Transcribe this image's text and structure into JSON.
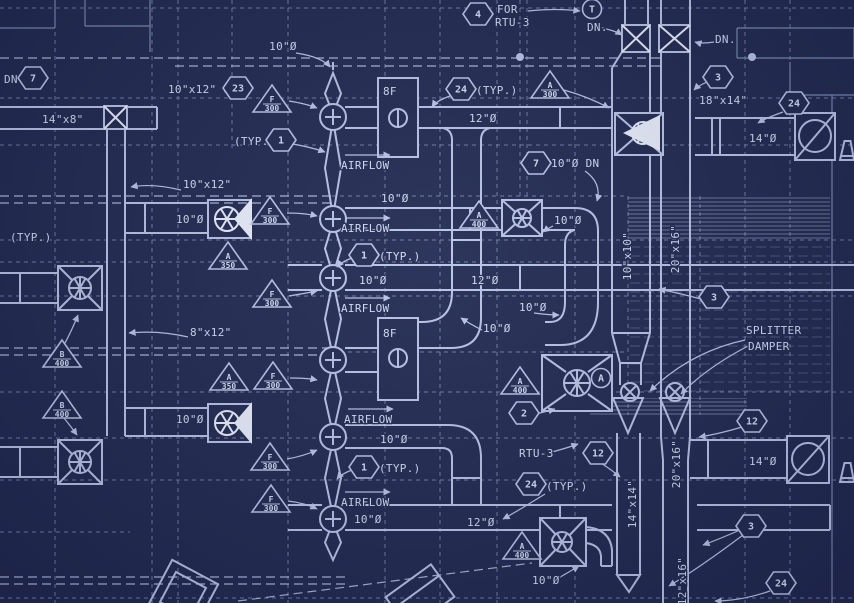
{
  "drawing": {
    "kind": "HVAC ductwork plan blueprint",
    "colors": {
      "background": "#222b53",
      "line": "#b9c5e8",
      "dim": "#7c8ab6",
      "bright": "#e9eefc",
      "text": "#d3ddf6"
    },
    "annotations": {
      "texts": [
        {
          "t": "10\"Ø",
          "x": 283,
          "y": 50,
          "a": "middle"
        },
        {
          "t": "DN",
          "x": 4,
          "y": 83,
          "a": "start"
        },
        {
          "t": "14\"x8\"",
          "x": 42,
          "y": 123,
          "a": "start"
        },
        {
          "t": "10\"x12\" UP",
          "x": 168,
          "y": 93,
          "a": "start"
        },
        {
          "t": "(TYP.)",
          "x": 234,
          "y": 145,
          "a": "start"
        },
        {
          "t": "10\"x12\"",
          "x": 183,
          "y": 188,
          "a": "start"
        },
        {
          "t": "10\"Ø",
          "x": 176,
          "y": 223,
          "a": "start"
        },
        {
          "t": "(TYP.)",
          "x": 10,
          "y": 241,
          "a": "start"
        },
        {
          "t": "8\"x12\"",
          "x": 190,
          "y": 336,
          "a": "start"
        },
        {
          "t": "10\"Ø",
          "x": 176,
          "y": 423,
          "a": "start"
        },
        {
          "t": "FOR",
          "x": 497,
          "y": 13,
          "a": "start"
        },
        {
          "t": "RTU-3",
          "x": 495,
          "y": 26,
          "a": "start"
        },
        {
          "t": "DN.",
          "x": 587,
          "y": 31,
          "a": "start"
        },
        {
          "t": "DN.",
          "x": 715,
          "y": 43,
          "a": "start"
        },
        {
          "t": "18\"x14\"",
          "x": 699,
          "y": 104,
          "a": "start"
        },
        {
          "t": "14\"Ø",
          "x": 749,
          "y": 142,
          "a": "start"
        },
        {
          "t": "(TYP.)",
          "x": 476,
          "y": 94,
          "a": "start"
        },
        {
          "t": "12\"Ø",
          "x": 469,
          "y": 122,
          "a": "start"
        },
        {
          "t": "8F",
          "x": 383,
          "y": 95,
          "a": "start"
        },
        {
          "t": "AIRFLOW",
          "x": 341,
          "y": 169,
          "a": "start"
        },
        {
          "t": "10\"Ø DN",
          "x": 551,
          "y": 167,
          "a": "start"
        },
        {
          "t": "10\"Ø",
          "x": 381,
          "y": 202,
          "a": "start"
        },
        {
          "t": "AIRFLOW",
          "x": 341,
          "y": 232,
          "a": "start"
        },
        {
          "t": "(TYP.)",
          "x": 379,
          "y": 260,
          "a": "start"
        },
        {
          "t": "10\"Ø",
          "x": 359,
          "y": 284,
          "a": "start"
        },
        {
          "t": "12\"Ø",
          "x": 471,
          "y": 284,
          "a": "start"
        },
        {
          "t": "10\"Ø",
          "x": 554,
          "y": 224,
          "a": "start"
        },
        {
          "t": "AIRFLOW",
          "x": 341,
          "y": 312,
          "a": "start"
        },
        {
          "t": "8F",
          "x": 383,
          "y": 337,
          "a": "start"
        },
        {
          "t": "10\"Ø",
          "x": 519,
          "y": 311,
          "a": "start"
        },
        {
          "t": "10\"Ø",
          "x": 483,
          "y": 332,
          "a": "start"
        },
        {
          "t": "SPLITTER",
          "x": 746,
          "y": 334,
          "a": "start"
        },
        {
          "t": "DAMPER",
          "x": 748,
          "y": 350,
          "a": "start"
        },
        {
          "t": "AIRFLOW",
          "x": 344,
          "y": 423,
          "a": "start"
        },
        {
          "t": "10\"Ø",
          "x": 380,
          "y": 443,
          "a": "start"
        },
        {
          "t": "RTU-3",
          "x": 519,
          "y": 457,
          "a": "start"
        },
        {
          "t": "(TYP.)",
          "x": 379,
          "y": 472,
          "a": "start"
        },
        {
          "t": "(TYP.)",
          "x": 546,
          "y": 490,
          "a": "start"
        },
        {
          "t": "AIRFLOW",
          "x": 341,
          "y": 506,
          "a": "start"
        },
        {
          "t": "10\"Ø",
          "x": 354,
          "y": 523,
          "a": "start"
        },
        {
          "t": "12\"Ø",
          "x": 467,
          "y": 526,
          "a": "start"
        },
        {
          "t": "10\"Ø",
          "x": 532,
          "y": 584,
          "a": "start"
        },
        {
          "t": "14\"Ø",
          "x": 749,
          "y": 465,
          "a": "start"
        }
      ],
      "vtexts": [
        {
          "t": "10\"x10\"",
          "x": 631,
          "y": 256
        },
        {
          "t": "20\"x16\"",
          "x": 679,
          "y": 249
        },
        {
          "t": "20\"x16\"",
          "x": 680,
          "y": 464
        },
        {
          "t": "14\"x14\"",
          "x": 636,
          "y": 504
        },
        {
          "t": "12\"x16\"",
          "x": 686,
          "y": 581
        }
      ],
      "hexagons": [
        {
          "v": "7",
          "x": 33,
          "y": 78
        },
        {
          "v": "23",
          "x": 238,
          "y": 88
        },
        {
          "v": "1",
          "x": 281,
          "y": 140
        },
        {
          "v": "4",
          "x": 478,
          "y": 14
        },
        {
          "v": "24",
          "x": 461,
          "y": 89
        },
        {
          "v": "7",
          "x": 536,
          "y": 163
        },
        {
          "v": "3",
          "x": 718,
          "y": 77
        },
        {
          "v": "24",
          "x": 794,
          "y": 103
        },
        {
          "v": "1",
          "x": 364,
          "y": 255
        },
        {
          "v": "3",
          "x": 714,
          "y": 297
        },
        {
          "v": "2",
          "x": 524,
          "y": 413
        },
        {
          "v": "1",
          "x": 364,
          "y": 467
        },
        {
          "v": "24",
          "x": 531,
          "y": 484
        },
        {
          "v": "12",
          "x": 598,
          "y": 453
        },
        {
          "v": "12",
          "x": 752,
          "y": 421
        },
        {
          "v": "3",
          "x": 751,
          "y": 526
        },
        {
          "v": "24",
          "x": 781,
          "y": 583
        }
      ],
      "triangles": [
        {
          "l": "F",
          "v": "300",
          "x": 272,
          "y": 101
        },
        {
          "l": "F",
          "v": "300",
          "x": 270,
          "y": 213
        },
        {
          "l": "A",
          "v": "350",
          "x": 228,
          "y": 258
        },
        {
          "l": "F",
          "v": "300",
          "x": 272,
          "y": 296
        },
        {
          "l": "B",
          "v": "400",
          "x": 62,
          "y": 356
        },
        {
          "l": "A",
          "v": "350",
          "x": 229,
          "y": 379
        },
        {
          "l": "F",
          "v": "300",
          "x": 273,
          "y": 378
        },
        {
          "l": "B",
          "v": "400",
          "x": 62,
          "y": 407
        },
        {
          "l": "F",
          "v": "300",
          "x": 270,
          "y": 459
        },
        {
          "l": "F",
          "v": "300",
          "x": 271,
          "y": 501
        },
        {
          "l": "A",
          "v": "300",
          "x": 550,
          "y": 87
        },
        {
          "l": "A",
          "v": "400",
          "x": 479,
          "y": 217
        },
        {
          "l": "A",
          "v": "400",
          "x": 520,
          "y": 383
        },
        {
          "l": "A",
          "v": "400",
          "x": 522,
          "y": 548
        }
      ],
      "circle_tags": [
        {
          "v": "T",
          "x": 592,
          "y": 9
        },
        {
          "v": "A",
          "x": 601,
          "y": 378
        }
      ]
    }
  }
}
